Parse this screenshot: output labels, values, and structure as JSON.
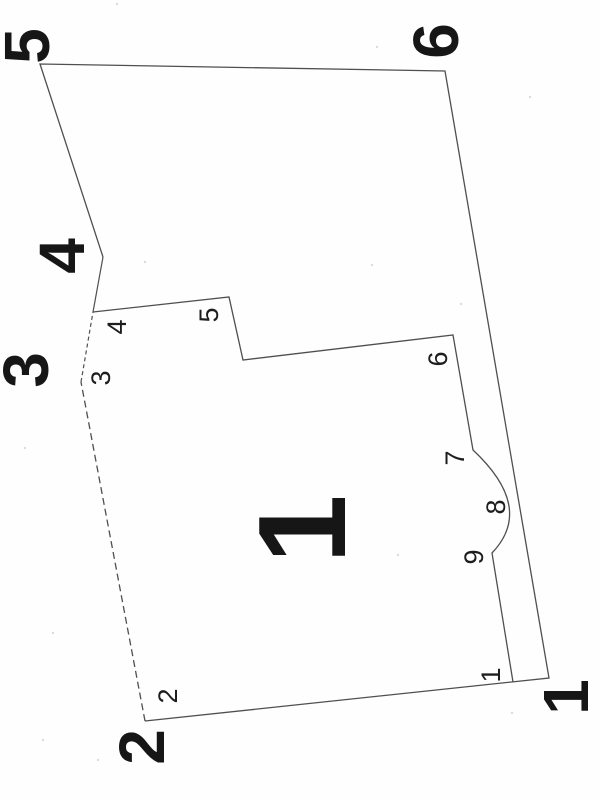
{
  "diagram": {
    "background_color": "#fefefe",
    "line_color": "#4f4f4f",
    "text_color": "#161616",
    "paths": {
      "outer_solid_outline": "M 103 257 L 40 64 L 445 71 L 549 678 L 145 721",
      "outer_notch_solid": "M 93 312 L 103 257",
      "left_edge_dashed_lower": "M 145 721 L 81 382",
      "left_edge_dashed_upper": "M 81 382 L 93 312",
      "panel_outline": "M 93 312 L 229 297 L 243 360 L 453 335 L 473 450 Q 535 508 492 553 L 513 682"
    },
    "dash_pattern_lower": "7 4",
    "dash_pattern_upper": "4 3",
    "labels": [
      {
        "id": "outer-5",
        "text": "5",
        "x": 27,
        "y": 46,
        "size": "large"
      },
      {
        "id": "outer-6",
        "text": "6",
        "x": 436,
        "y": 41,
        "size": "large"
      },
      {
        "id": "outer-4",
        "text": "4",
        "x": 62,
        "y": 256,
        "size": "large"
      },
      {
        "id": "outer-3",
        "text": "3",
        "x": 26,
        "y": 370,
        "size": "large"
      },
      {
        "id": "outer-2",
        "text": "2",
        "x": 142,
        "y": 747,
        "size": "large"
      },
      {
        "id": "outer-1",
        "text": "1",
        "x": 566,
        "y": 697,
        "size": "large"
      },
      {
        "id": "panel-1",
        "text": "1",
        "x": 303,
        "y": 529,
        "size": "panel"
      },
      {
        "id": "inner-4",
        "text": "4",
        "x": 117,
        "y": 327,
        "size": "small"
      },
      {
        "id": "inner-5",
        "text": "5",
        "x": 209,
        "y": 315,
        "size": "small"
      },
      {
        "id": "inner-3",
        "text": "3",
        "x": 101,
        "y": 378,
        "size": "small"
      },
      {
        "id": "inner-6",
        "text": "6",
        "x": 438,
        "y": 359,
        "size": "small"
      },
      {
        "id": "inner-7",
        "text": "7",
        "x": 455,
        "y": 458,
        "size": "small"
      },
      {
        "id": "inner-8",
        "text": "8",
        "x": 496,
        "y": 507,
        "size": "small"
      },
      {
        "id": "inner-9",
        "text": "9",
        "x": 474,
        "y": 557,
        "size": "small"
      },
      {
        "id": "inner-1",
        "text": "1",
        "x": 491,
        "y": 675,
        "size": "small"
      },
      {
        "id": "inner-2",
        "text": "2",
        "x": 168,
        "y": 696,
        "size": "small"
      }
    ],
    "label_rotation_deg": -90,
    "scan_specks": [
      {
        "x": 117,
        "y": 4
      },
      {
        "x": 377,
        "y": 47
      },
      {
        "x": 530,
        "y": 97
      },
      {
        "x": 145,
        "y": 262
      },
      {
        "x": 372,
        "y": 265
      },
      {
        "x": 461,
        "y": 304
      },
      {
        "x": 25,
        "y": 448
      },
      {
        "x": 398,
        "y": 555
      },
      {
        "x": 53,
        "y": 633
      },
      {
        "x": 43,
        "y": 740
      },
      {
        "x": 98,
        "y": 760
      },
      {
        "x": 512,
        "y": 713
      }
    ]
  }
}
